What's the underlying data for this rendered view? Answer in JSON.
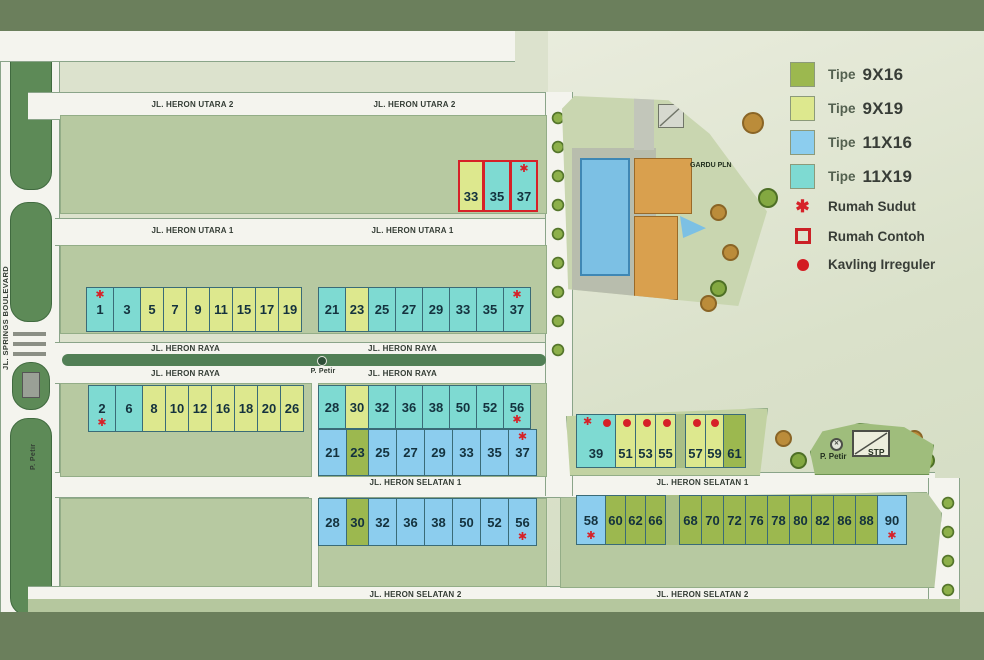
{
  "streets": {
    "utara2": "JL. HERON UTARA 2",
    "utara1": "JL. HERON UTARA 1",
    "raya": "JL. HERON RAYA",
    "selatan1": "JL. HERON SELATAN 1",
    "selatan2": "JL. HERON SELATAN 2",
    "boulevard": "JL. SPRINGS BOULEVARD"
  },
  "labels": {
    "p_petir": "P. Petir",
    "stp": "STP",
    "gardu_pln": "GARDU PLN"
  },
  "colors": {
    "tipe_9x16": "#9cb84f",
    "tipe_9x19": "#dde88e",
    "tipe_11x16": "#8ccdee",
    "tipe_11x19": "#7edad2",
    "marker_red": "#d62128"
  },
  "legend": {
    "types": [
      {
        "label": "Tipe",
        "value": "9X16",
        "color": "#9cb84f"
      },
      {
        "label": "Tipe",
        "value": "9X19",
        "color": "#dde88e"
      },
      {
        "label": "Tipe",
        "value": "11X16",
        "color": "#8ccdee"
      },
      {
        "label": "Tipe",
        "value": "11X19",
        "color": "#7edad2"
      }
    ],
    "markers": [
      {
        "icon": "asterisk",
        "label": "Rumah Sudut"
      },
      {
        "icon": "outlined-square",
        "label": "Rumah Contoh"
      },
      {
        "icon": "filled-dot",
        "label": "Kavling Irreguler"
      }
    ]
  },
  "lot_rows": {
    "contoh": {
      "cells": [
        {
          "n": "33",
          "t": "y19",
          "w": 26,
          "m": [
            "contoh"
          ]
        },
        {
          "n": "35",
          "t": "c19",
          "m": [
            "contoh"
          ]
        },
        {
          "n": "37",
          "t": "c19",
          "m": [
            "contoh",
            "star-top"
          ]
        }
      ]
    },
    "utara1_left": {
      "cells": [
        {
          "n": "1",
          "t": "c19",
          "m": [
            "star-top"
          ]
        },
        {
          "n": "3",
          "t": "c19"
        },
        {
          "n": "5",
          "t": "y19"
        },
        {
          "n": "7",
          "t": "y19"
        },
        {
          "n": "9",
          "t": "y19"
        },
        {
          "n": "11",
          "t": "y19"
        },
        {
          "n": "15",
          "t": "y19"
        },
        {
          "n": "17",
          "t": "y19"
        },
        {
          "n": "19",
          "t": "y19"
        }
      ]
    },
    "utara1_right": {
      "cells": [
        {
          "n": "21",
          "t": "c19"
        },
        {
          "n": "23",
          "t": "y19"
        },
        {
          "n": "25",
          "t": "c19"
        },
        {
          "n": "27",
          "t": "c19"
        },
        {
          "n": "29",
          "t": "c19"
        },
        {
          "n": "33",
          "t": "c19"
        },
        {
          "n": "35",
          "t": "c19"
        },
        {
          "n": "37",
          "t": "c19",
          "m": [
            "star-top"
          ]
        }
      ]
    },
    "raya_left": {
      "cells": [
        {
          "n": "2",
          "t": "c19",
          "m": [
            "star-bottom"
          ]
        },
        {
          "n": "6",
          "t": "c19"
        },
        {
          "n": "8",
          "t": "y19"
        },
        {
          "n": "10",
          "t": "y19"
        },
        {
          "n": "12",
          "t": "y19"
        },
        {
          "n": "16",
          "t": "y19"
        },
        {
          "n": "18",
          "t": "y19"
        },
        {
          "n": "20",
          "t": "y19"
        },
        {
          "n": "26",
          "t": "y19"
        }
      ]
    },
    "raya_right_top": {
      "cells": [
        {
          "n": "28",
          "t": "c19"
        },
        {
          "n": "30",
          "t": "y19"
        },
        {
          "n": "32",
          "t": "c19"
        },
        {
          "n": "36",
          "t": "c19"
        },
        {
          "n": "38",
          "t": "c19"
        },
        {
          "n": "50",
          "t": "c19"
        },
        {
          "n": "52",
          "t": "c19"
        },
        {
          "n": "56",
          "t": "c19",
          "m": [
            "star-bottom"
          ]
        }
      ]
    },
    "raya_right_bottom": {
      "cells": [
        {
          "n": "21",
          "t": "b16"
        },
        {
          "n": "23",
          "t": "g16"
        },
        {
          "n": "25",
          "t": "b16"
        },
        {
          "n": "27",
          "t": "b16"
        },
        {
          "n": "29",
          "t": "b16"
        },
        {
          "n": "33",
          "t": "b16"
        },
        {
          "n": "35",
          "t": "b16"
        },
        {
          "n": "37",
          "t": "b16",
          "m": [
            "star-top"
          ]
        }
      ]
    },
    "irregular": {
      "cells": [
        {
          "n": "39",
          "t": "c19",
          "w": 40,
          "m": [
            "star-top",
            "dot"
          ]
        },
        {
          "n": "51",
          "t": "y19",
          "w": 21,
          "m": [
            "dot"
          ]
        },
        {
          "n": "53",
          "t": "y19",
          "w": 21,
          "m": [
            "dot"
          ]
        },
        {
          "n": "55",
          "t": "y19",
          "w": 21,
          "m": [
            "dot"
          ]
        },
        {
          "t": "strip",
          "w": 10
        },
        {
          "n": "57",
          "t": "y19",
          "w": 21,
          "m": [
            "dot"
          ]
        },
        {
          "n": "59",
          "t": "y19",
          "w": 19,
          "m": [
            "dot"
          ]
        },
        {
          "n": "61",
          "t": "g16",
          "w": 23
        }
      ]
    },
    "selatan1_mid": {
      "cells": [
        {
          "n": "28",
          "t": "b16"
        },
        {
          "n": "30",
          "t": "g16"
        },
        {
          "n": "32",
          "t": "b16"
        },
        {
          "n": "36",
          "t": "b16"
        },
        {
          "n": "38",
          "t": "b16"
        },
        {
          "n": "50",
          "t": "b16"
        },
        {
          "n": "52",
          "t": "b16"
        },
        {
          "n": "56",
          "t": "b16",
          "m": [
            "star-bottom"
          ]
        }
      ]
    },
    "selatan1_right": {
      "cells": [
        {
          "n": "58",
          "t": "b16",
          "w": 30,
          "m": [
            "star-bottom"
          ]
        },
        {
          "n": "60",
          "t": "g16",
          "w": 21
        },
        {
          "n": "62",
          "t": "g16",
          "w": 21
        },
        {
          "n": "66",
          "t": "g16",
          "w": 21
        },
        {
          "t": "strip",
          "w": 14
        },
        {
          "n": "68",
          "t": "g16",
          "w": 23
        },
        {
          "n": "70",
          "t": "g16",
          "w": 23
        },
        {
          "n": "72",
          "t": "g16",
          "w": 23
        },
        {
          "n": "76",
          "t": "g16",
          "w": 23
        },
        {
          "n": "78",
          "t": "g16",
          "w": 23
        },
        {
          "n": "80",
          "t": "g16",
          "w": 23
        },
        {
          "n": "82",
          "t": "g16",
          "w": 23
        },
        {
          "n": "86",
          "t": "g16",
          "w": 23
        },
        {
          "n": "88",
          "t": "g16",
          "w": 23
        },
        {
          "n": "90",
          "t": "b16",
          "w": 30,
          "m": [
            "star-bottom"
          ]
        }
      ]
    }
  }
}
